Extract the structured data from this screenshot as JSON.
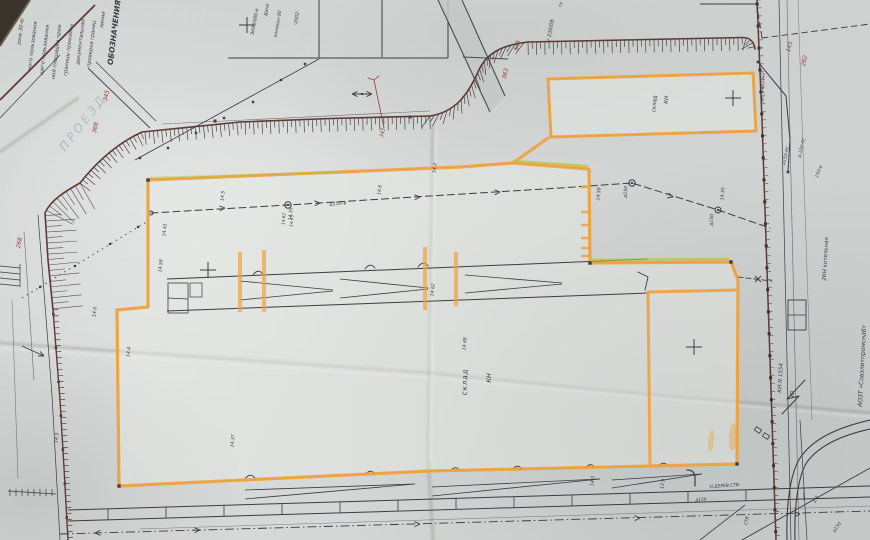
{
  "scene": {
    "title_block": "ОБОЗНАЧЕНИЯ :"
  },
  "colors": {
    "paper": "#d4d8d6",
    "ink": "#3c3c42",
    "maroon": "#5e3a33",
    "orange": "#f0a23c",
    "highlight_green": "#b9c23a",
    "red": "#9a3a30",
    "faint": "#8fa0ad",
    "dark_corner": "#3a342c"
  },
  "labels": {
    "legend": [
      {
        "text": "зоне 30-ю",
        "x": 22,
        "y": 32,
        "rot": -83,
        "size": 5.2
      },
      {
        "text": "ного пользования",
        "x": 34,
        "y": 46,
        "rot": -83,
        "size": 5.2
      },
      {
        "text": "щего пользования",
        "x": 46,
        "y": 50,
        "rot": -83,
        "size": 5.2
      },
      {
        "text": "ной площадки пром",
        "x": 58,
        "y": 52,
        "rot": -83,
        "size": 5.2
      },
      {
        "text": "границы промзоны",
        "x": 70,
        "y": 50,
        "rot": -83,
        "size": 5.2
      },
      {
        "text": "документальная",
        "x": 82,
        "y": 42,
        "rot": -83,
        "size": 5.2
      },
      {
        "text": "проверка границ",
        "x": 93,
        "y": 44,
        "rot": -83,
        "size": 5.2
      },
      {
        "text": "линии",
        "x": 104,
        "y": 20,
        "rot": -83,
        "size": 5.2
      },
      {
        "text": "ОБОЗНАЧЕНИЯ :",
        "x": 117,
        "y": 30,
        "rot": -83,
        "size": 7.5,
        "bold": true
      }
    ],
    "top_fragments": [
      {
        "text": "ЭК80/080-в",
        "x": 256,
        "y": 22,
        "rot": -80,
        "size": 4.6
      },
      {
        "text": "Дани",
        "x": 268,
        "y": 10,
        "rot": -80,
        "size": 4.6
      },
      {
        "text": "конюшн-80",
        "x": 279,
        "y": 24,
        "rot": -80,
        "size": 4.6
      },
      {
        "text": "-2002-",
        "x": 298,
        "y": 18,
        "rot": -80,
        "size": 4.6
      },
      {
        "text": "т 230/08.",
        "x": 552,
        "y": 30,
        "rot": -80,
        "size": 5
      },
      {
        "text": "та",
        "x": 562,
        "y": 5,
        "rot": -80,
        "size": 4.5
      }
    ],
    "road": [
      {
        "text": "ПРОЕЗД",
        "x": 86,
        "y": 125,
        "rot": -52,
        "size": 12,
        "color": "faint",
        "ls": 3
      }
    ],
    "buildings": [
      {
        "text": "склад",
        "x": 467,
        "y": 382,
        "rot": -88,
        "size": 7,
        "ls": 1
      },
      {
        "text": "КН",
        "x": 491,
        "y": 378,
        "rot": -88,
        "size": 6.5
      },
      {
        "text": "склад",
        "x": 656,
        "y": 104,
        "rot": -85,
        "size": 5.5
      },
      {
        "text": "КН",
        "x": 668,
        "y": 100,
        "rot": -85,
        "size": 5.5
      }
    ],
    "right_margin": [
      {
        "text": "КН N 1554",
        "x": 782,
        "y": 378,
        "rot": -87,
        "size": 5.5
      },
      {
        "text": "Ю",
        "x": 794,
        "y": 394,
        "rot": -87,
        "size": 5.5
      },
      {
        "text": "2КН котельная",
        "x": 827,
        "y": 259,
        "rot": -87,
        "size": 5.5
      },
      {
        "text": "АОЗТ «Совэлитпромснабт",
        "x": 864,
        "y": 366,
        "rot": -87,
        "size": 6
      },
      {
        "text": "заб. р-003-№2",
        "x": 764,
        "y": 88,
        "rot": -87,
        "size": 4.2
      },
      {
        "text": "д150-РС",
        "x": 787,
        "y": 156,
        "rot": -75,
        "size": 4.5
      },
      {
        "text": "д-100-РС",
        "x": 803,
        "y": 148,
        "rot": -75,
        "size": 4.5
      },
      {
        "text": "150-в",
        "x": 820,
        "y": 172,
        "rot": -70,
        "size": 4.5
      },
      {
        "text": "д150",
        "x": 838,
        "y": 528,
        "rot": -55,
        "size": 4.5
      },
      {
        "text": "2.5",
        "x": 817,
        "y": 500,
        "rot": -60,
        "size": 4.5
      },
      {
        "text": "СТВ",
        "x": 748,
        "y": 521,
        "rot": -80,
        "size": 4.5
      }
    ],
    "benchmarks": [
      {
        "text": "345",
        "x": 108,
        "y": 96,
        "rot": -78,
        "size": 5.8,
        "color": "red"
      },
      {
        "text": "368",
        "x": 97,
        "y": 128,
        "rot": -78,
        "size": 5.8,
        "color": "red"
      },
      {
        "text": "345",
        "x": 519,
        "y": 46,
        "rot": -78,
        "size": 5.8,
        "color": "red"
      },
      {
        "text": "363",
        "x": 507,
        "y": 74,
        "rot": -78,
        "size": 5.8,
        "color": "red"
      },
      {
        "text": "145",
        "x": 791,
        "y": 47,
        "rot": -78,
        "size": 5.8,
        "color": "red"
      },
      {
        "text": "282",
        "x": 806,
        "y": 61,
        "rot": -78,
        "size": 5.8,
        "color": "red"
      },
      {
        "text": "268",
        "x": 21,
        "y": 243,
        "rot": -78,
        "size": 5.8,
        "color": "red"
      },
      {
        "text": "343",
        "x": 384,
        "y": 133,
        "rot": -78,
        "size": 5,
        "color": "red"
      }
    ],
    "elevations": [
      {
        "text": "14.58",
        "x": 162,
        "y": 266
      },
      {
        "text": "14.5",
        "x": 224,
        "y": 196
      },
      {
        "text": "14.35",
        "x": 292,
        "y": 214
      },
      {
        "text": "14.6",
        "x": 381,
        "y": 190
      },
      {
        "text": "14.2",
        "x": 436,
        "y": 168
      },
      {
        "text": "14.58",
        "x": 600,
        "y": 194
      },
      {
        "text": "14.35",
        "x": 724,
        "y": 194
      },
      {
        "text": "14.62",
        "x": 434,
        "y": 290
      },
      {
        "text": "14.48",
        "x": 466,
        "y": 344
      },
      {
        "text": "14.5",
        "x": 594,
        "y": 481
      },
      {
        "text": "13.9",
        "x": 664,
        "y": 484
      },
      {
        "text": "14.41",
        "x": 166,
        "y": 230
      },
      {
        "text": "14.3",
        "x": 58,
        "y": 438
      },
      {
        "text": "14.37",
        "x": 234,
        "y": 441
      },
      {
        "text": "14.6",
        "x": 96,
        "y": 312
      },
      {
        "text": "14.4",
        "x": 130,
        "y": 352
      }
    ],
    "utilities": [
      {
        "text": "д150-в",
        "x": 338,
        "y": 205,
        "rot": -4,
        "size": 4.8
      },
      {
        "text": "д150",
        "x": 627,
        "y": 192,
        "rot": -85,
        "size": 4.6
      },
      {
        "text": "д150",
        "x": 713,
        "y": 220,
        "rot": -85,
        "size": 4.6
      },
      {
        "text": "14.62",
        "x": 285,
        "y": 219,
        "rot": -85,
        "size": 4.2
      },
      {
        "text": "14.35",
        "x": 293,
        "y": 221,
        "rot": -85,
        "size": 4.2
      },
      {
        "text": "Н.ДЕРЕВ.СТВ.",
        "x": 725,
        "y": 487,
        "rot": -4,
        "size": 4.4
      },
      {
        "text": "д150",
        "x": 701,
        "y": 501,
        "rot": -4,
        "size": 4.4
      }
    ]
  }
}
